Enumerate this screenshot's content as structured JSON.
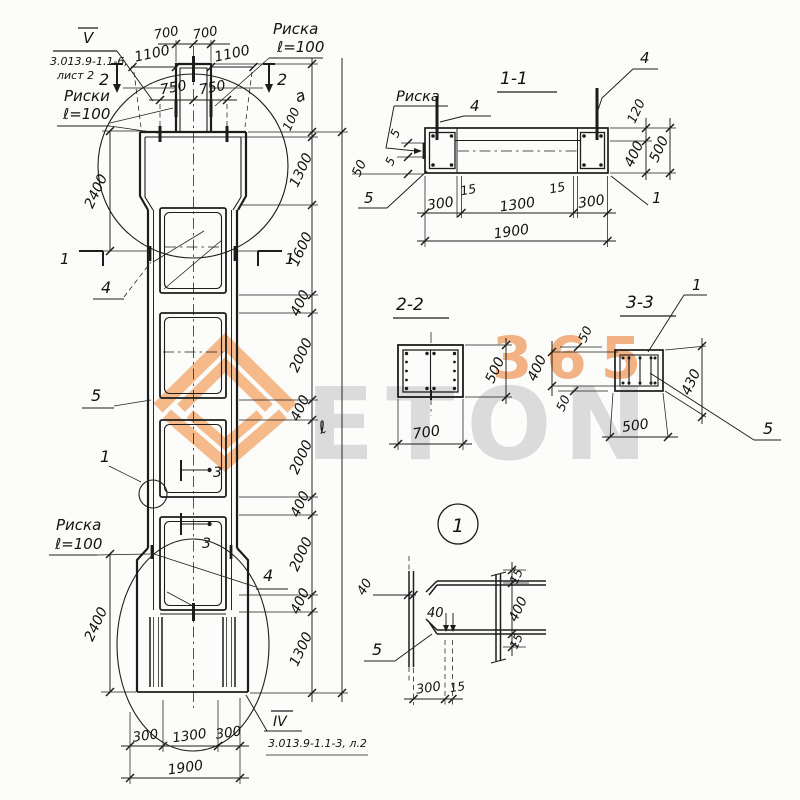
{
  "watermark": {
    "word": "ETON",
    "digits": "365",
    "orange": "#f3a76e",
    "gray": "#dadada"
  },
  "ref_top": {
    "num": "V",
    "line1": "3.013.9-1.1-6,",
    "line2": "лист 2"
  },
  "ref_bottom": {
    "num": "IV",
    "text": "3.013.9-1.1-3, л.2"
  },
  "ev": {
    "d700a": "700",
    "d700b": "700",
    "d1100a": "1100",
    "d1100b": "1100",
    "d750a": "750",
    "d750b": "750",
    "d2400a": "2400",
    "d2400b": "2400",
    "chain": [
      "a",
      "100",
      "1300",
      "1600",
      "400",
      "2000",
      "400",
      "2000",
      "400",
      "2000",
      "400",
      "1300"
    ],
    "total": "ℓ",
    "b300a": "300",
    "b1300": "1300",
    "b300b": "300",
    "b1900": "1900",
    "riski1": "Риски",
    "riski1b": "ℓ=100",
    "riska_tr": "Риска",
    "riska_trb": "ℓ=100",
    "riska_bl": "Риска",
    "riska_blb": "ℓ=100",
    "c2a": "2",
    "c2b": "2",
    "c1a": "1",
    "c1b": "1",
    "c3a": "3",
    "c3b": "3",
    "i4a": "4",
    "i5": "5",
    "i1": "1",
    "i4b": "4"
  },
  "s11": {
    "title": "1-1",
    "riska": "Риска",
    "i4a": "4",
    "i4b": "4",
    "i5": "5",
    "i1": "1",
    "d5a": "5",
    "d5b": "5",
    "d50": "50",
    "d120": "120",
    "d400": "400",
    "d500": "500",
    "d15a": "15",
    "d15b": "15",
    "d300a": "300",
    "d1300": "1300",
    "d300b": "300",
    "d1900": "1900"
  },
  "s22": {
    "title": "2-2",
    "d500": "500",
    "d700": "700"
  },
  "s33": {
    "title": "3-3",
    "i1": "1",
    "i5": "5",
    "d50a": "50",
    "d400": "400",
    "d50b": "50",
    "d430": "430",
    "d500": "500"
  },
  "d1": {
    "num": "1",
    "d40a": "40",
    "d40b": "40",
    "d15a": "15",
    "d400": "400",
    "d15b": "15",
    "d300": "300",
    "d15c": "15",
    "i5": "5"
  }
}
